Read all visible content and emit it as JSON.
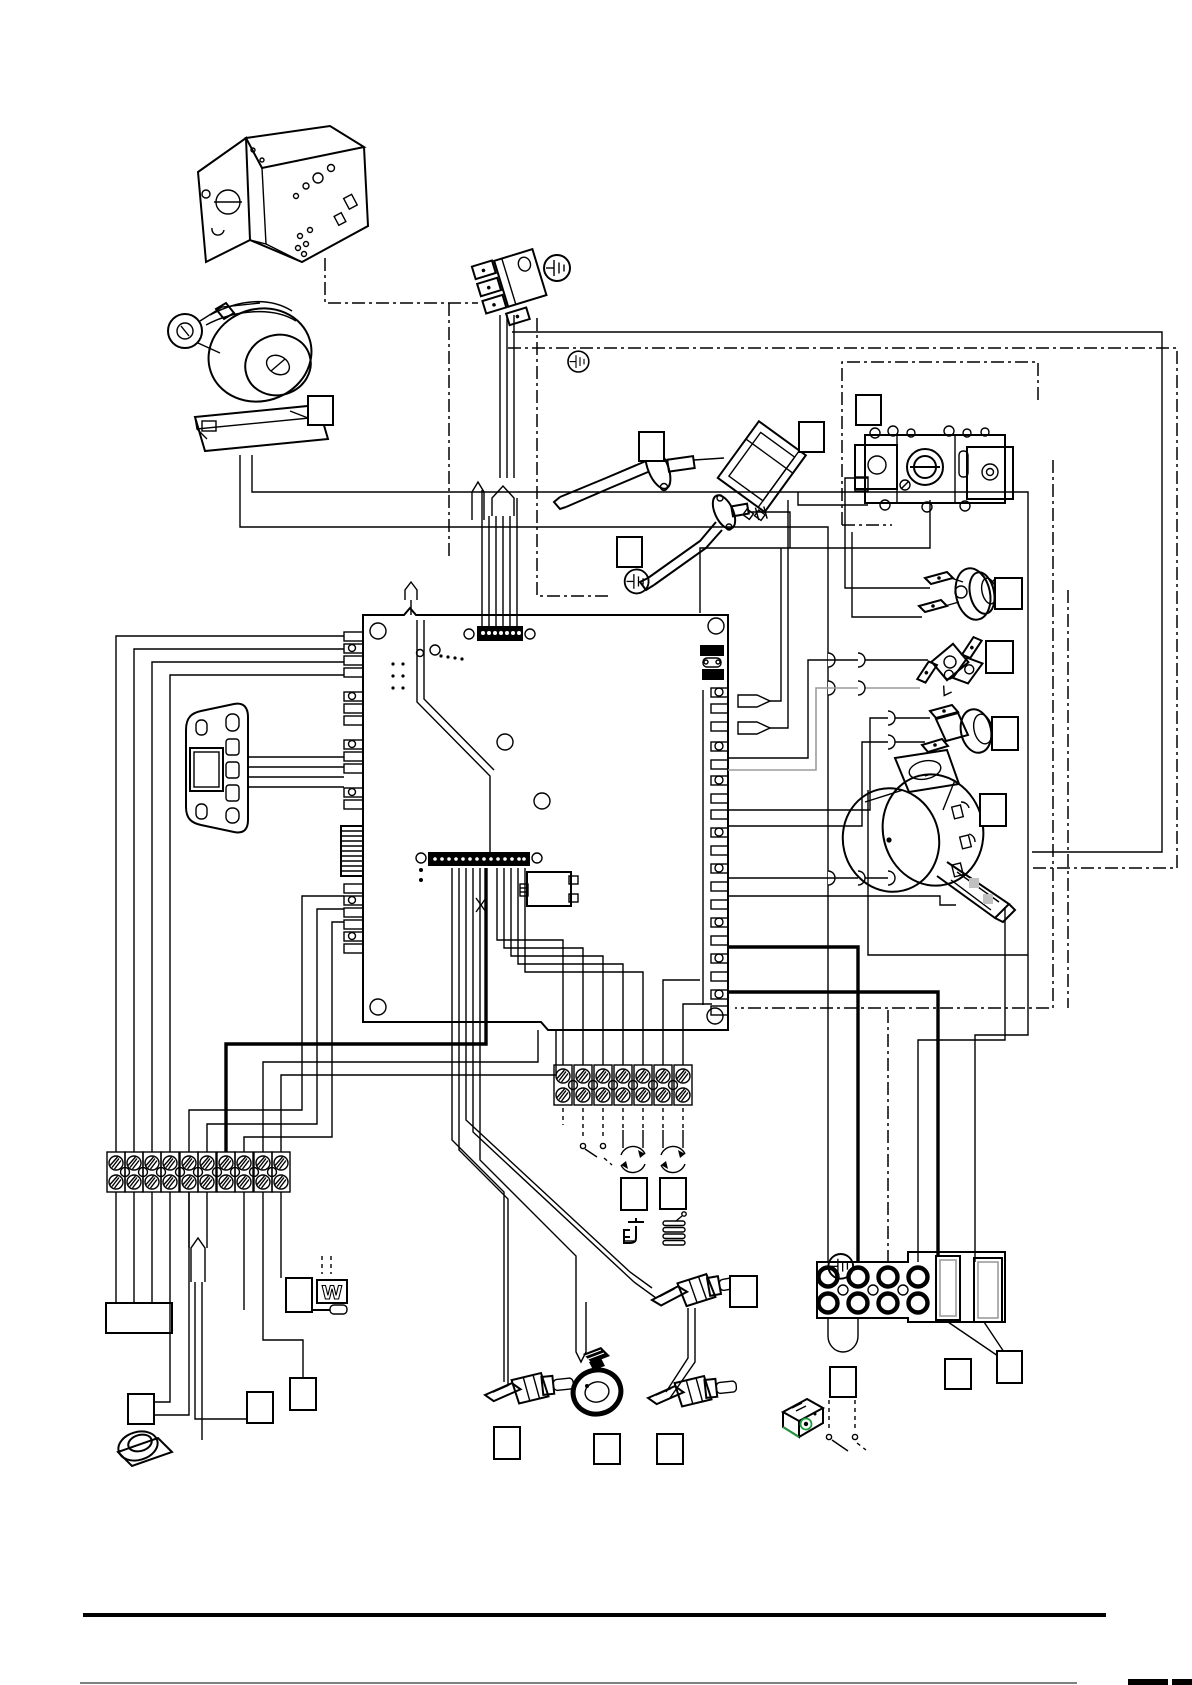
{
  "page": {
    "kind": "boiler wiring diagram page",
    "background": "#ffffff",
    "ink": "#000000",
    "accent_green": "#1f9c3d",
    "gray": "#9c9c9c",
    "footer_rule": true,
    "footer_edge_marks": true
  },
  "symbols": {
    "w_label": "W",
    "earth_symbol_count": 4,
    "callout_box_count": 22,
    "callout_boxes_are_empty": true
  },
  "components": [
    {
      "id": "control-box-bracket",
      "desc": "sheet-metal control box, top left"
    },
    {
      "id": "circulation-pump",
      "desc": "pump with motor terminal box"
    },
    {
      "id": "mains-input-connector",
      "desc": "3-pole mains connector with earth symbol"
    },
    {
      "id": "spark-electrode",
      "desc": "ignition electrode with flange"
    },
    {
      "id": "ignition-transformer",
      "desc": "spark generator block"
    },
    {
      "id": "flame-sensing-electrode",
      "desc": "single sensing electrode"
    },
    {
      "id": "gas-valve",
      "desc": "gas valve assembly inside dash-dot enclosure"
    },
    {
      "id": "thermostat-1",
      "desc": "clip-on limit thermostat with two spade terminals"
    },
    {
      "id": "thermostat-2",
      "desc": "angled safety thermostat"
    },
    {
      "id": "thermostat-3",
      "desc": "clip-on thermostat"
    },
    {
      "id": "fan",
      "desc": "flue fan with plug-in connector"
    },
    {
      "id": "main-pcb",
      "desc": "main control board with edge connectors, fuse and earth point"
    },
    {
      "id": "pcb-fuse",
      "desc": "fuse with two black holder blocks"
    },
    {
      "id": "display-panel",
      "desc": "control panel with LCD window and buttons"
    },
    {
      "id": "terminal-strip-10way",
      "desc": "screw terminal strip, bottom left"
    },
    {
      "id": "terminal-strip-7way",
      "desc": "screw terminal strip, bottom centre"
    },
    {
      "id": "right-terminal-block",
      "desc": "screw terminal block with two link modules"
    },
    {
      "id": "wire-link-loop",
      "desc": "U link under right terminal block"
    },
    {
      "id": "room-thermostat-switch",
      "desc": "dashed external switch symbol"
    },
    {
      "id": "motorised-valve-symbol-1",
      "desc": "circular arrows symbol"
    },
    {
      "id": "motorised-valve-symbol-2",
      "desc": "circular arrows symbol"
    },
    {
      "id": "tap-icon",
      "desc": "domestic hot water tap glyph"
    },
    {
      "id": "radiator-coil-icon",
      "desc": "heating coil glyph"
    },
    {
      "id": "ntc-sensor-1",
      "desc": "probe sensor, bottom centre right"
    },
    {
      "id": "ntc-sensor-2",
      "desc": "probe sensor, bottom centre left"
    },
    {
      "id": "ntc-sensor-3",
      "desc": "probe sensor, bottom centre"
    },
    {
      "id": "water-pressure-sensor",
      "desc": "dark transducer"
    },
    {
      "id": "temperature-dial",
      "desc": "round dial, bottom left"
    },
    {
      "id": "timer-module",
      "desc": "small accessory box drawn with green edges"
    },
    {
      "id": "junction-box",
      "desc": "plain rectangle under 10-way strip"
    },
    {
      "id": "w-symbol-box",
      "desc": "box containing letter W with plug icon"
    },
    {
      "id": "cable-loom-sleeves",
      "desc": "pointed sleeve symbols on wire bundles"
    }
  ]
}
